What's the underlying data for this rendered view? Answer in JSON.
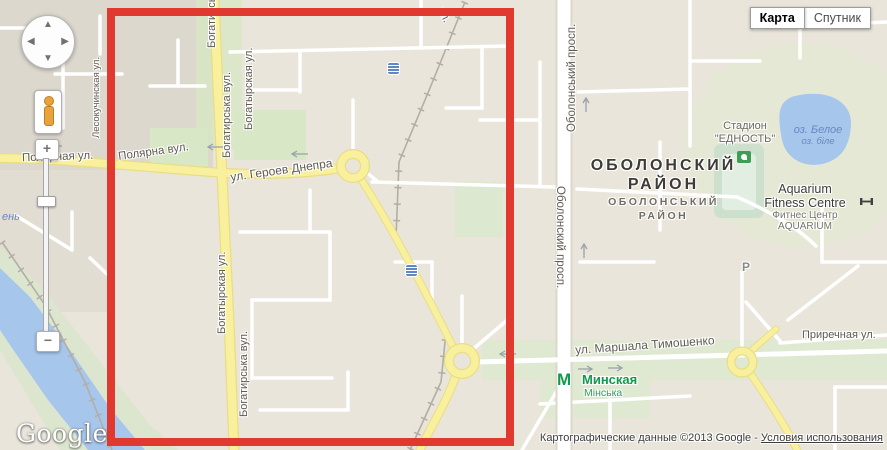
{
  "controls": {
    "map_button": "Карта",
    "satellite_button": "Спутник",
    "zoom_in": "+",
    "zoom_out": "−",
    "pan_up": "▲",
    "pan_down": "▼",
    "pan_left": "◀",
    "pan_right": "▶"
  },
  "logo_text": "Google",
  "attribution": {
    "prefix": "Картографические данные ©2013 Google - ",
    "terms": "Условия использования"
  },
  "map_labels": {
    "polyarnaya_ru": "Полярная ул.",
    "polyarna_ua": "Полярна вул.",
    "geroev_dnepra": "ул. Героев Днепра",
    "bogatyrska_ua_top": "Богатирська вул.",
    "bogatyrskaya_ru_top": "Богатырская ул.",
    "bogatyrskaya_ru_mid": "Богатырская ул.",
    "bogatyrska_ua_bottom": "Богатирська вул.",
    "bogatyrska_cut": "Богатирська",
    "lesokuchinskaya": "Лесокучинская ул.",
    "street_fragment": "ул.",
    "obolonsky_prosp_ua": "Оболонський просп.",
    "obolonsky_prosp_ru": "Оболонский просп.",
    "district_ru_line1": "ОБОЛОНСКИЙ",
    "district_ru_line2": "РАЙОН",
    "district_ua_line1": "ОБОЛОНСЬКИЙ",
    "district_ua_line2": "РАЙОН",
    "stadium_line1": "Стадион",
    "stadium_line2": "\"ЕДНОСТЬ\"",
    "lake_ru": "оз. Белое",
    "lake_ua": "оз. біле",
    "aquarium_line1": "Aquarium",
    "aquarium_line2": "Fitness Centre",
    "aquarium_sub1": "Фитнес Центр",
    "aquarium_sub2": "AQUARIUM",
    "timoshenko": "ул. Маршала Тимошенко",
    "minska_ru": "Минская",
    "minska_ua": "Мінська",
    "metro_m": "М",
    "prirechnaya": "Приречная ул.",
    "parking": "Р",
    "water_partial": "ень"
  },
  "colors": {
    "selection_red": "#e0392f",
    "road_yellow": "#f9f09e",
    "water_blue": "#a7c6ec",
    "park_green": "#d8e7c6",
    "metro_green": "#0f9b4c"
  },
  "icons": {
    "pan": "pan-compass-icon",
    "pegman": "pegman-icon",
    "transit": "transit-stop-icon",
    "stadium": "stadium-icon",
    "fitness": "fitness-icon",
    "metro": "metro-m-icon"
  }
}
